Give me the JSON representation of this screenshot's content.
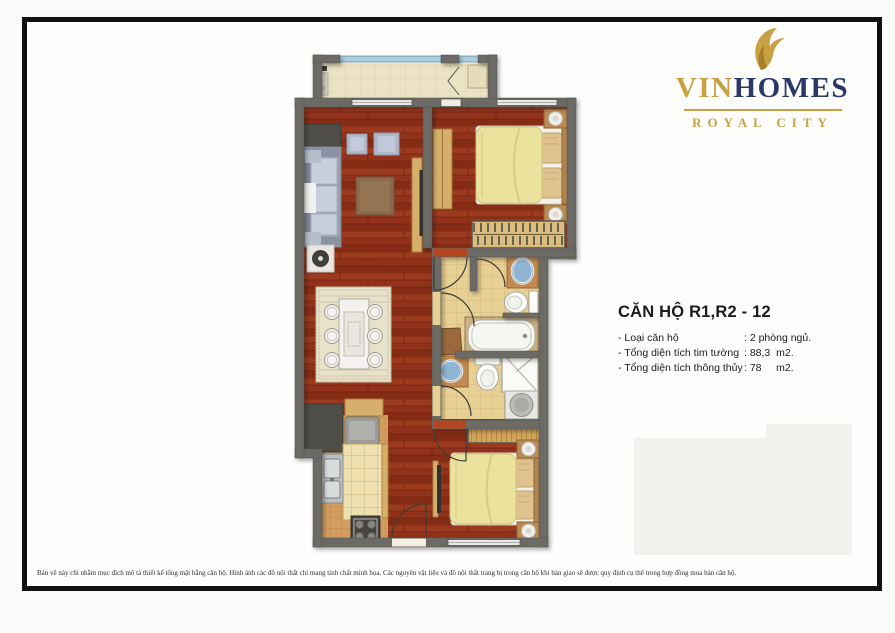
{
  "brand": {
    "name_prefix": "VIN",
    "name_suffix": "HOMES",
    "subtitle": "ROYAL CITY",
    "gold": "#c8a144",
    "navy": "#2c3968"
  },
  "info": {
    "title": "CĂN HỘ R1,R2 - 12",
    "rows": [
      {
        "label": "- Loại căn hộ",
        "value": ": 2 phòng ngủ."
      },
      {
        "label": "- Tổng diện tích tim tường",
        "value": ": 88,3  m2."
      },
      {
        "label": "- Tổng diện tích thông thủy",
        "value": ": 78     m2."
      }
    ]
  },
  "disclaimer": "Bản vẽ này chỉ nhằm mục đích mô tả thiết kế tổng mặt bằng căn hộ. Hình ảnh các đồ nội thất chỉ mang tính chất minh họa. Các nguyên vật liệu và đồ nội thất trang bị trong căn hộ khi bàn giao sẽ được quy định cụ thể trong hợp đồng mua bán căn hộ.",
  "floorplan": {
    "apartment_type": "2 bedrooms",
    "rooms": [
      "balcony",
      "living-room",
      "dining-area",
      "kitchen",
      "hallway",
      "bedroom-1",
      "bathroom-1",
      "bathroom-2",
      "bedroom-2"
    ],
    "colors": {
      "wall": "#6c6b65",
      "wood_floor": "#93321b",
      "bathroom_tile": "#e7d094",
      "kitchen_tile": "#d39d60",
      "balcony_tile": "#ebe3c3",
      "bed_duvet": "#eae29d",
      "sofa": "#99a1b0",
      "vanity_wood": "#c28a50",
      "sink_blue": "#8fb4d4"
    }
  }
}
